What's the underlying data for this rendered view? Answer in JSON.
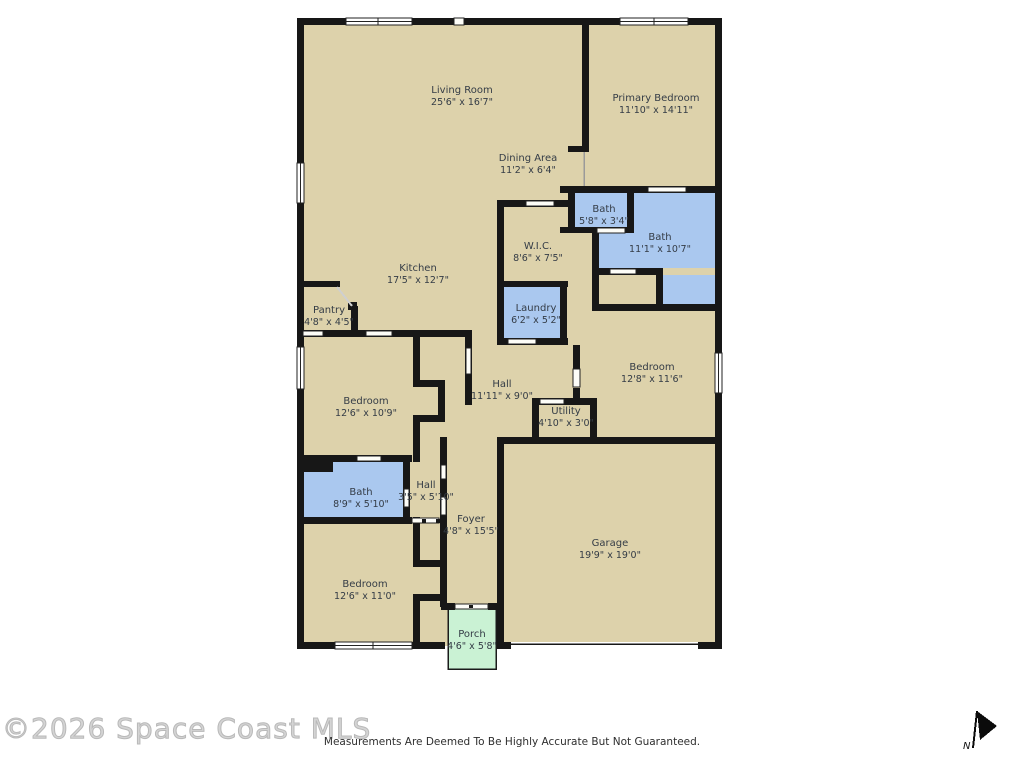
{
  "floorplan": {
    "colors": {
      "floor": "#ddd2ab",
      "wall": "#171717",
      "wet_room": "#aac8ef",
      "porch": "#caf2d4",
      "label_text": "#343c46",
      "watermark": "#c4c4c4"
    },
    "rooms": [
      {
        "id": "living-room",
        "label": "Living Room",
        "dims": "25'6\" x 16'7\""
      },
      {
        "id": "primary-bedroom",
        "label": "Primary Bedroom",
        "dims": "11'10\" x 14'11\""
      },
      {
        "id": "dining-area",
        "label": "Dining Area",
        "dims": "11'2\" x 6'4\""
      },
      {
        "id": "bath-small",
        "label": "Bath",
        "dims": "5'8\" x 3'4\""
      },
      {
        "id": "bath-primary",
        "label": "Bath",
        "dims": "11'1\" x 10'7\""
      },
      {
        "id": "walk-in-closet",
        "label": "W.I.C.",
        "dims": "8'6\" x 7'5\""
      },
      {
        "id": "kitchen",
        "label": "Kitchen",
        "dims": "17'5\" x 12'7\""
      },
      {
        "id": "pantry",
        "label": "Pantry",
        "dims": "4'8\" x 4'5\""
      },
      {
        "id": "laundry",
        "label": "Laundry",
        "dims": "6'2\" x 5'2\""
      },
      {
        "id": "bedroom-east",
        "label": "Bedroom",
        "dims": "12'8\" x 11'6\""
      },
      {
        "id": "hall",
        "label": "Hall",
        "dims": "11'11\" x 9'0\""
      },
      {
        "id": "utility",
        "label": "Utility",
        "dims": "4'10\" x 3'0\""
      },
      {
        "id": "bedroom-west-upper",
        "label": "Bedroom",
        "dims": "12'6\" x 10'9\""
      },
      {
        "id": "bath-west",
        "label": "Bath",
        "dims": "8'9\" x 5'10\""
      },
      {
        "id": "hall-small",
        "label": "Hall",
        "dims": "3'5\" x 5'10\""
      },
      {
        "id": "foyer",
        "label": "Foyer",
        "dims": "4'8\" x 15'5\""
      },
      {
        "id": "bedroom-west-lower",
        "label": "Bedroom",
        "dims": "12'6\" x 11'0\""
      },
      {
        "id": "garage",
        "label": "Garage",
        "dims": "19'9\" x 19'0\""
      },
      {
        "id": "porch",
        "label": "Porch",
        "dims": "4'6\" x 5'8\""
      }
    ]
  },
  "footer": {
    "watermark": "©2026 Space Coast MLS",
    "disclaimer": "Measurements Are Deemed To Be Highly Accurate But Not Guaranteed.",
    "compass_label": "N"
  }
}
